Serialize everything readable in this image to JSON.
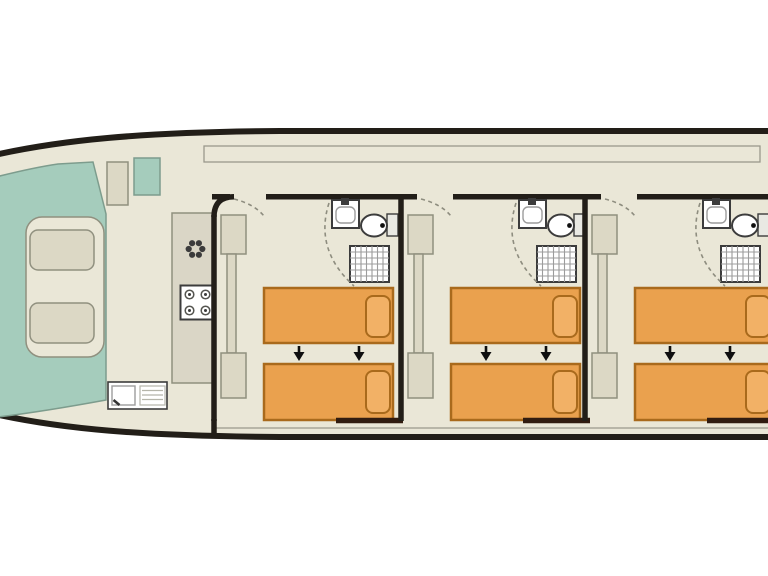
{
  "title": "houseboat-deck-plan",
  "canvas": {
    "width": 768,
    "height": 576
  },
  "colors": {
    "bg": "#ffffff",
    "hull_fill": "#eae7d7",
    "hull_outline": "#221e18",
    "teal": "#a5ccbc",
    "teal_border": "#7d9c8d",
    "beige": "#dcd8c5",
    "beige_border": "#90907f",
    "counter": "#dad6c6",
    "bed": "#eaa14e",
    "bed_border": "#a96a1c",
    "pillow": "#f2b166",
    "wall": "#221e18",
    "wall2": "#311c10",
    "fixture": "#3c3c3c",
    "tank": "#e9e9e3",
    "grid": "#9c9c9c",
    "thin": "#9a998c",
    "dash": "#8e8d7f",
    "arrow": "#0f0f0f"
  },
  "boat": {
    "type": "canal-houseboat deck plan, bow at left, stern cropped at right",
    "bow_cockpit": {
      "label": "bow-cockpit",
      "deck_color_key": "teal",
      "seating_well": {
        "cushion_count": 2
      },
      "side_items": [
        "helm-seat",
        "deck-locker"
      ]
    },
    "galley": {
      "label": "galley",
      "appliances": [
        "fridge",
        "hob-4-burner",
        "sink-with-drainer"
      ]
    },
    "cabins": [
      {
        "label": "cabin-1",
        "wall_x": 214,
        "wall_top": 215,
        "bed_width": 129,
        "features": [
          "twin-beds",
          "sliding-bed-arrows",
          "wardrobe",
          "washbasin",
          "toilet",
          "shower"
        ]
      },
      {
        "label": "cabin-2",
        "wall_x": 401,
        "wall_top": 194,
        "bed_width": 129,
        "features": [
          "twin-beds",
          "sliding-bed-arrows",
          "wardrobe",
          "washbasin",
          "toilet",
          "shower"
        ]
      },
      {
        "label": "cabin-3",
        "wall_x": 585,
        "wall_top": 194,
        "bed_width": 138,
        "features": [
          "twin-beds",
          "sliding-bed-arrows",
          "wardrobe",
          "washbasin",
          "toilet",
          "shower"
        ]
      }
    ],
    "beds_per_cabin": 2,
    "arrows_per_cabin": 2,
    "arrow_direction": "down"
  },
  "icons": [
    {
      "name": "fridge-snowflake-icon",
      "meaning": "refrigerator"
    },
    {
      "name": "hob-burners-icon",
      "meaning": "4-ring cooker"
    },
    {
      "name": "shower-grid-icon",
      "meaning": "shower tray"
    },
    {
      "name": "toilet-icon",
      "meaning": "marine toilet"
    },
    {
      "name": "washbasin-icon",
      "meaning": "washbasin with tap"
    },
    {
      "name": "bed-slide-arrow-icon",
      "meaning": "beds convert/slide together"
    }
  ]
}
